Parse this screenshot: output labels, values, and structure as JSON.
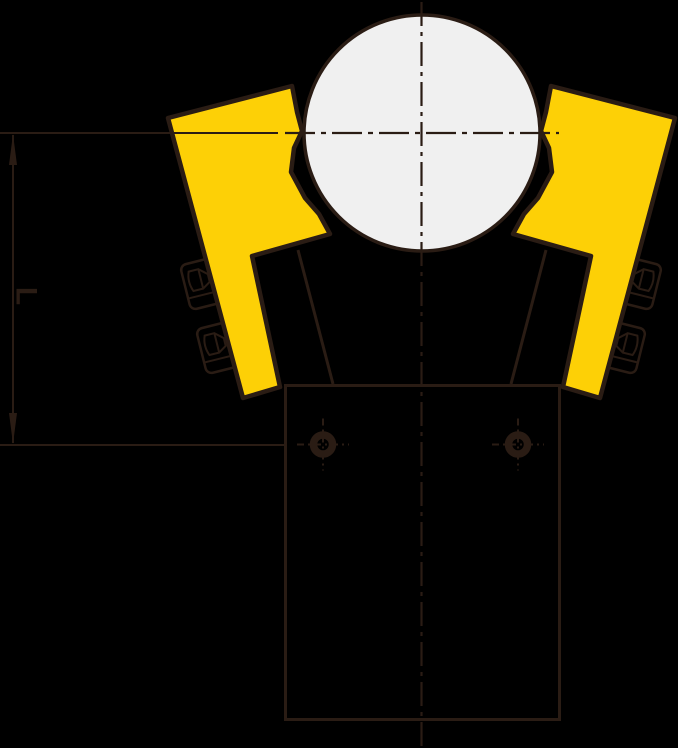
{
  "dimension": {
    "label": "L"
  },
  "colors": {
    "background": "#000000",
    "ink": "#2a1c14",
    "clamp_yellow": "#fdd006",
    "pipe_fill": "#f0f0f0"
  }
}
